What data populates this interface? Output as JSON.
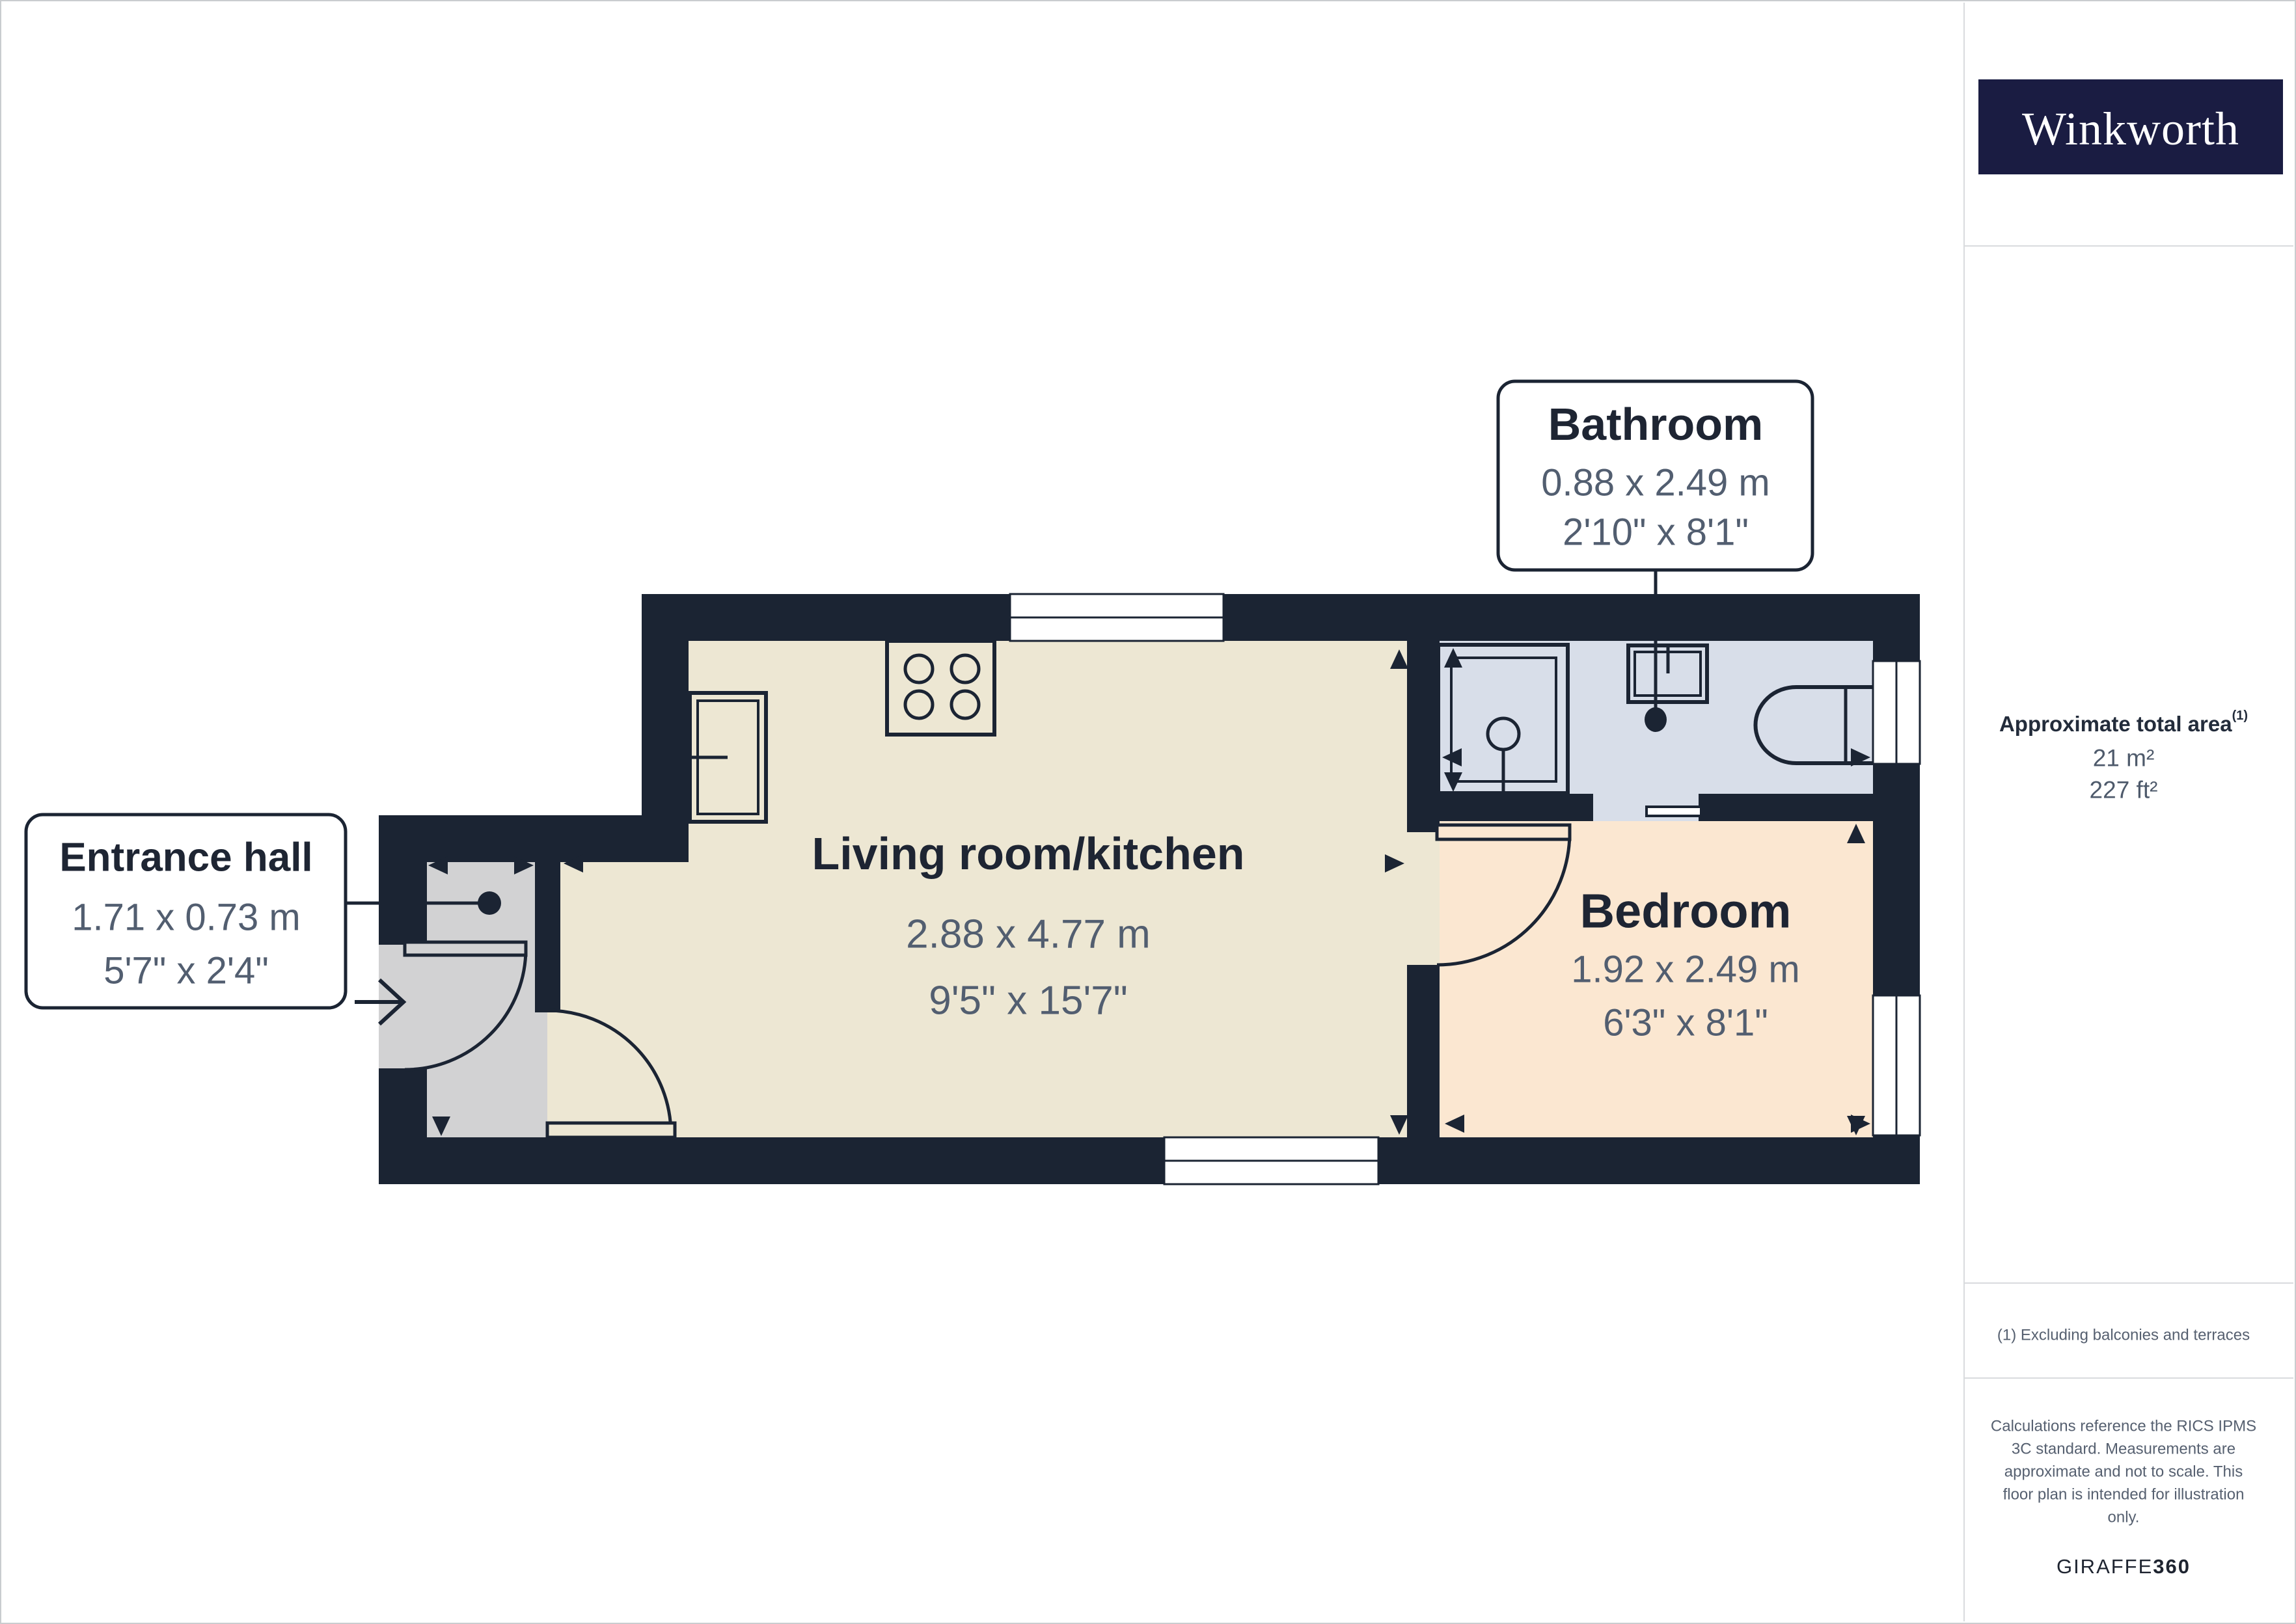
{
  "brand": {
    "logo_text": "Winkworth",
    "logo_bg": "#1A1C42"
  },
  "sidebar": {
    "area_label": "Approximate total area",
    "area_sup": "(1)",
    "area_metric": "21 m²",
    "area_imperial": "227 ft²",
    "footnote": "(1) Excluding balconies and terraces",
    "disclaimer_lines": [
      "Calculations reference the RICS IPMS",
      "3C standard. Measurements are",
      "approximate and not to scale. This",
      "floor plan is intended for illustration",
      "only."
    ],
    "credit_brand": "GIRAFFE",
    "credit_suffix": "360"
  },
  "rooms": {
    "living": {
      "name": "Living room/kitchen",
      "metric": "2.88 x 4.77 m",
      "imperial": "9'5\" x 15'7\""
    },
    "bedroom": {
      "name": "Bedroom",
      "metric": "1.92 x 2.49 m",
      "imperial": "6'3\" x 8'1\""
    },
    "bathroom": {
      "name": "Bathroom",
      "metric": "0.88 x 2.49 m",
      "imperial": "2'10\" x 8'1\""
    },
    "entrance": {
      "name": "Entrance hall",
      "metric": "1.71 x 0.73 m",
      "imperial": "5'7\" x 2'4\""
    }
  },
  "colors": {
    "wall": "#1B2433",
    "living_floor": "#EDE7D3",
    "bedroom_floor": "#FBE7D1",
    "bathroom_floor": "#D8DEE9",
    "hall_floor": "#D2D2D3",
    "logo_navy": "#1A1C42"
  }
}
